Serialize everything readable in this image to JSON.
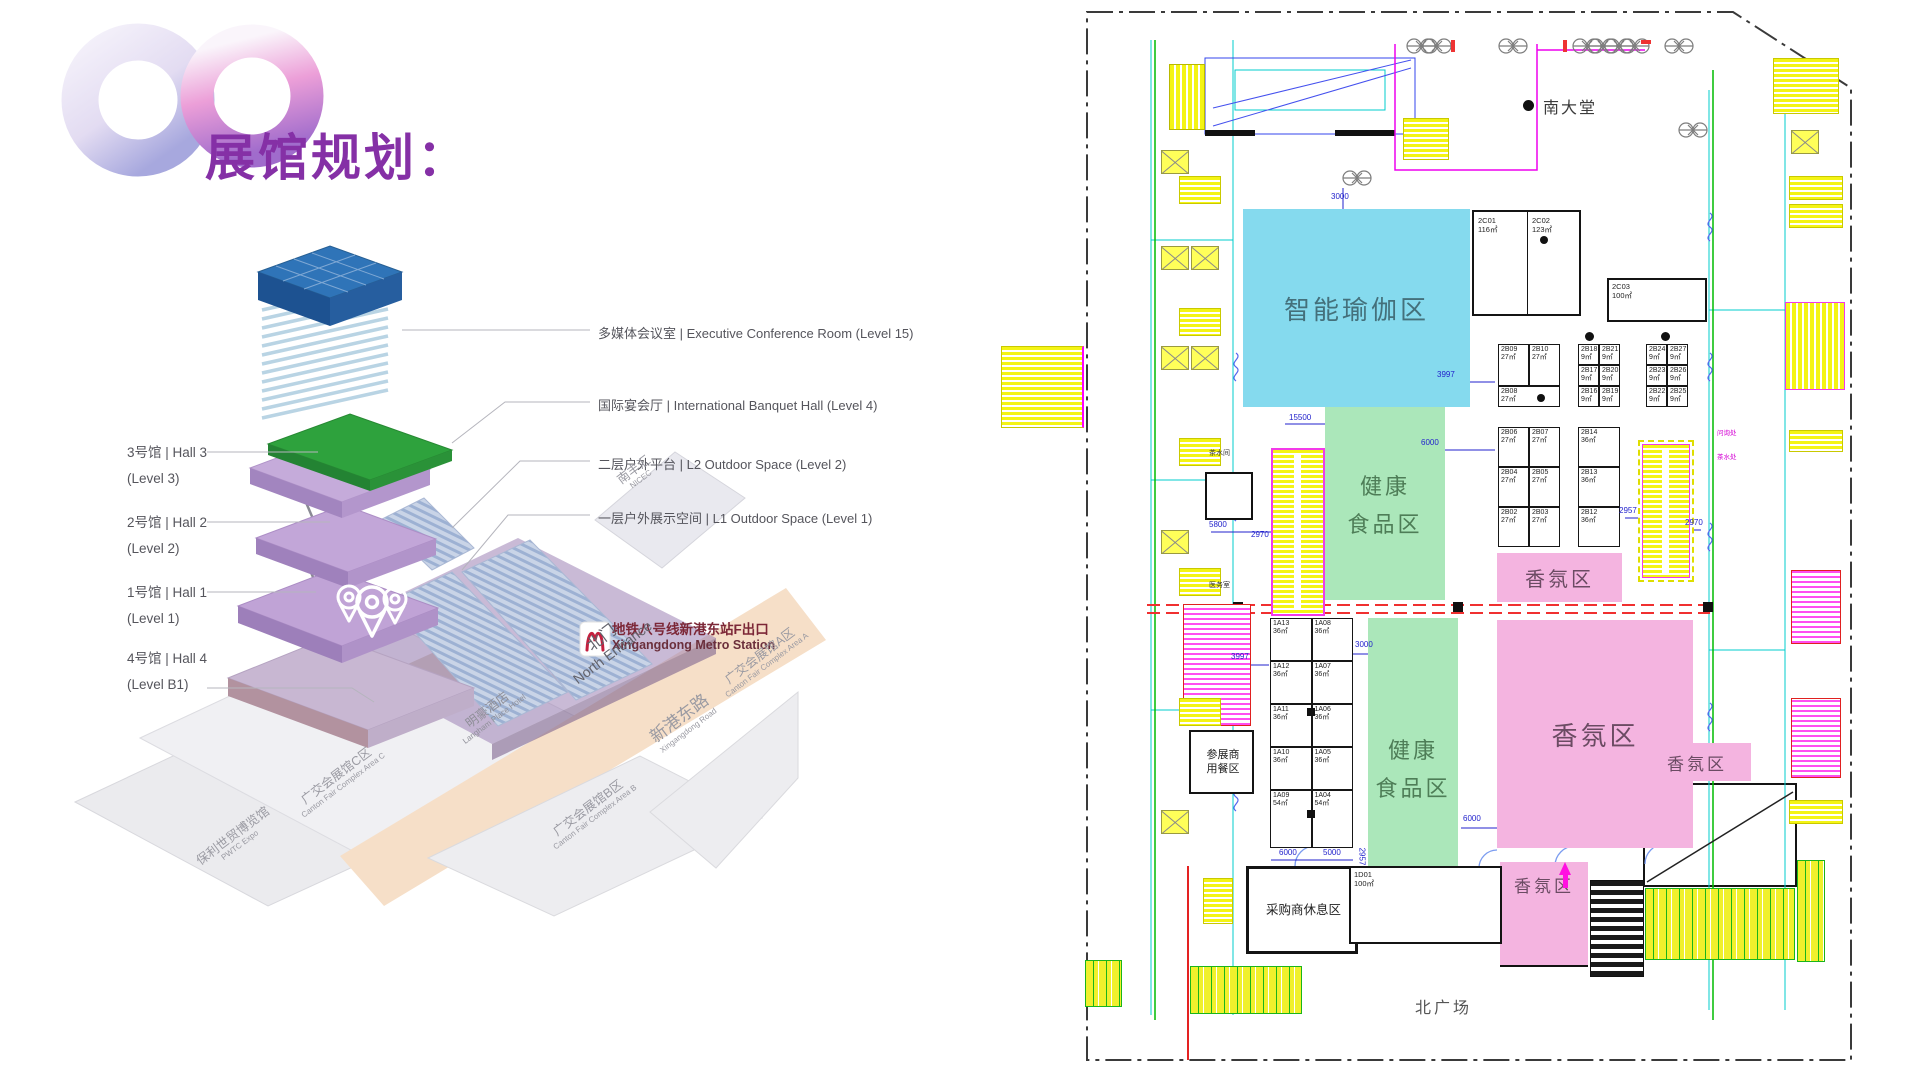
{
  "title": "展馆规划：",
  "diagram": {
    "right_labels": [
      "多媒体会议室 | Executive Conference Room (Level 15)",
      "国际宴会厅 | International Banquet Hall (Level 4)",
      "二层户外平台 | L2 Outdoor Space (Level 2)",
      "一层户外展示空间 | L1 Outdoor Space (Level 1)"
    ],
    "left_labels": [
      {
        "l1": "3号馆 | Hall 3",
        "l2": "(Level 3)"
      },
      {
        "l1": "2号馆 | Hall 2",
        "l2": "(Level 2)"
      },
      {
        "l1": "1号馆 | Hall 1",
        "l2": "(Level 1)"
      },
      {
        "l1": "4号馆 | Hall 4",
        "l2": "(Level B1)"
      }
    ],
    "metro": {
      "zh": "地铁八号线新港东站F出口",
      "en": "Xingangdong Metro Station"
    },
    "sites": {
      "north_gate": {
        "zh": "北门",
        "en": "North Entrance"
      },
      "road": {
        "zh": "新港东路",
        "en": "Xingangdong Road"
      },
      "area_a": {
        "zh": "广交会展馆A区",
        "en": "Canton Fair Complex Area A"
      },
      "area_b": {
        "zh": "广交会展馆B区",
        "en": "Canton Fair Complex Area B"
      },
      "area_c": {
        "zh": "广交会展馆C区",
        "en": "Canton Fair Complex Area C"
      },
      "pwtc": {
        "zh": "保利世贸博览馆",
        "en": "PWTC Expo"
      },
      "hotel": {
        "zh": "明豪酒店",
        "en": "Langham Place Hotel"
      },
      "nicec": {
        "zh": "南丰汇",
        "en": "NICEC"
      }
    }
  },
  "plan": {
    "zones": {
      "yoga": "智能瑜伽区",
      "food_l1": "健康",
      "food_l2": "食品区",
      "scent": "香氛区"
    },
    "areas": {
      "south_lobby": "南大堂",
      "north_plaza": "北广场",
      "dining_l1": "参展商",
      "dining_l2": "用餐区",
      "buyer_rest": "采购商休息区",
      "tea_left": "茶水间",
      "clinic": "医务室",
      "info_desk": "问询处",
      "tea_right": "茶水处"
    },
    "rooms": {
      "c01_id": "2C01",
      "c01_s": "116㎡",
      "c02_id": "2C02",
      "c02_s": "123㎡",
      "c03_id": "2C03",
      "c03_s": "100㎡",
      "d09_id": "1D09",
      "d09_s": "208㎡",
      "d01_id": "1D01",
      "d01_s": "100㎡"
    },
    "bA": [
      {
        "id": "2B09",
        "s": "27㎡"
      },
      {
        "id": "2B10",
        "s": "27㎡"
      },
      {
        "id": "2B08",
        "s": "27㎡"
      }
    ],
    "bB": [
      {
        "id": "2B18",
        "s": "9㎡"
      },
      {
        "id": "2B21",
        "s": "9㎡"
      },
      {
        "id": "2B17",
        "s": "9㎡"
      },
      {
        "id": "2B20",
        "s": "9㎡"
      },
      {
        "id": "2B16",
        "s": "9㎡"
      },
      {
        "id": "2B19",
        "s": "9㎡"
      }
    ],
    "bC": [
      {
        "id": "2B24",
        "s": "9㎡"
      },
      {
        "id": "2B27",
        "s": "9㎡"
      },
      {
        "id": "2B23",
        "s": "9㎡"
      },
      {
        "id": "2B26",
        "s": "9㎡"
      },
      {
        "id": "2B22",
        "s": "9㎡"
      },
      {
        "id": "2B25",
        "s": "9㎡"
      }
    ],
    "bD": [
      {
        "id": "2B06",
        "s": "27㎡"
      },
      {
        "id": "2B07",
        "s": "27㎡"
      },
      {
        "id": "2B04",
        "s": "27㎡"
      },
      {
        "id": "2B05",
        "s": "27㎡"
      },
      {
        "id": "2B02",
        "s": "27㎡"
      },
      {
        "id": "2B03",
        "s": "27㎡"
      }
    ],
    "bE": [
      {
        "id": "2B14",
        "s": "36㎡"
      },
      {
        "id": "2B13",
        "s": "36㎡"
      },
      {
        "id": "2B12",
        "s": "36㎡"
      }
    ],
    "b1A": [
      {
        "id": "1A13",
        "s": "36㎡"
      },
      {
        "id": "1A08",
        "s": "36㎡"
      },
      {
        "id": "1A12",
        "s": "36㎡"
      },
      {
        "id": "1A07",
        "s": "36㎡"
      },
      {
        "id": "1A11",
        "s": "36㎡"
      },
      {
        "id": "1A06",
        "s": "36㎡"
      },
      {
        "id": "1A10",
        "s": "36㎡"
      },
      {
        "id": "1A05",
        "s": "36㎡"
      },
      {
        "id": "1A09",
        "s": "54㎡"
      },
      {
        "id": "1A04",
        "s": "54㎡"
      }
    ],
    "dims": [
      "3000",
      "15500",
      "3997",
      "6000",
      "5800",
      "2970",
      "2957",
      "2970",
      "3997",
      "3000",
      "6000",
      "5000",
      "2957",
      "6000"
    ]
  }
}
